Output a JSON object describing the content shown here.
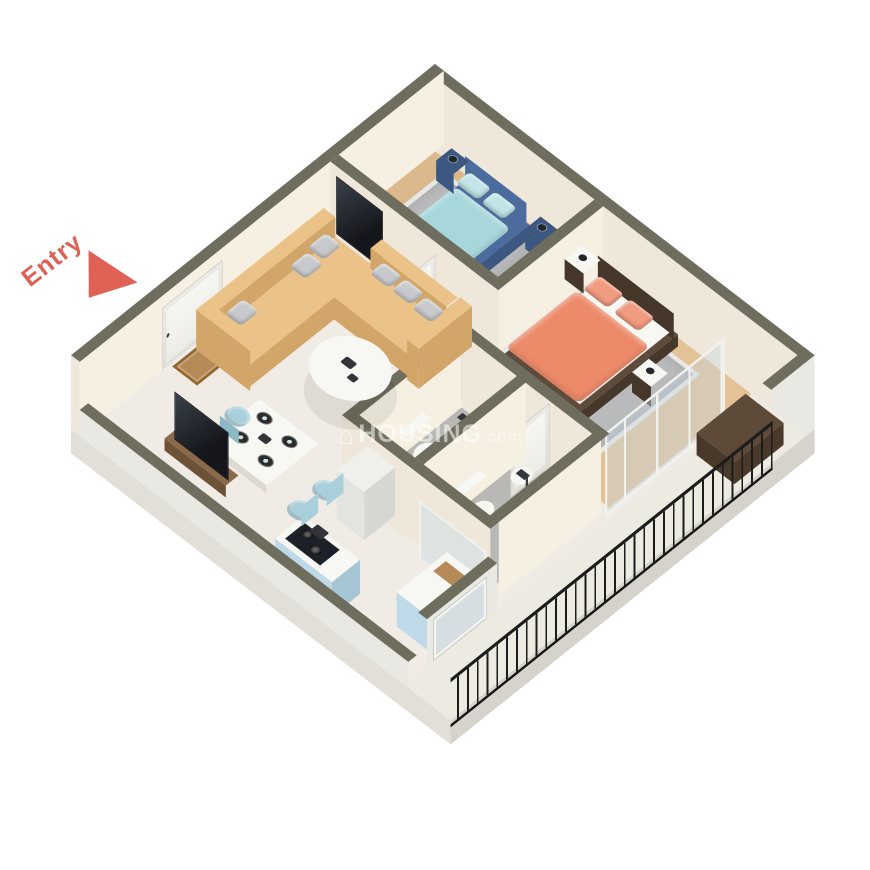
{
  "entry": {
    "label": "Entry"
  },
  "watermark": {
    "icon": "house-icon",
    "text": "HOUSING",
    "suffix": ".com"
  },
  "colors": {
    "wallTop": "#6f6d5d",
    "wallIn": "#efe8da",
    "wallInL": "#f6f0e3",
    "wallExt": "#eae8e2",
    "slab": "#d6d3cc",
    "slabL": "#e2dfd8",
    "marble": "#f0ece5",
    "balconyFloor": "#edeae2",
    "wood": "#dcb98c",
    "wood2": "#e2c296",
    "tile": "#b9b8b4",
    "rug": "#b9babc",
    "accent": "#df6055",
    "sofa": "#ebc287",
    "sofaD": "#d2a569",
    "bed1": "#4d6c9e",
    "bed1D": "#3c5780",
    "cyan": "#a8d7db",
    "cyanL": "#c2e4e6",
    "coral": "#ec8a6a",
    "coralL": "#f19b80",
    "frame2": "#5d4b3c",
    "frame2D": "#453729",
    "chair": "#a9cfdb",
    "chairD": "#8db8c6",
    "kblue": "#bed9e7",
    "kblueD": "#a6c5d5",
    "fridge": "#efefeb",
    "fridgeF": "#e3e3df",
    "fridgeS": "#d6d6d2",
    "tv": "#1d2127",
    "wood3": "#8a6a4a",
    "wood3D": "#6e5237",
    "bench": "#5e4a39",
    "benchD": "#49392b",
    "white": "#f7f7f4",
    "whiteD": "#dcd9d1",
    "mat": "#b68a57",
    "dark": "#34363c",
    "pillow": "#c8c9cc",
    "shadow": "rgba(0,0,0,0.07)",
    "doorW": "#f6f5f1",
    "rail": "#1c1c1a"
  }
}
